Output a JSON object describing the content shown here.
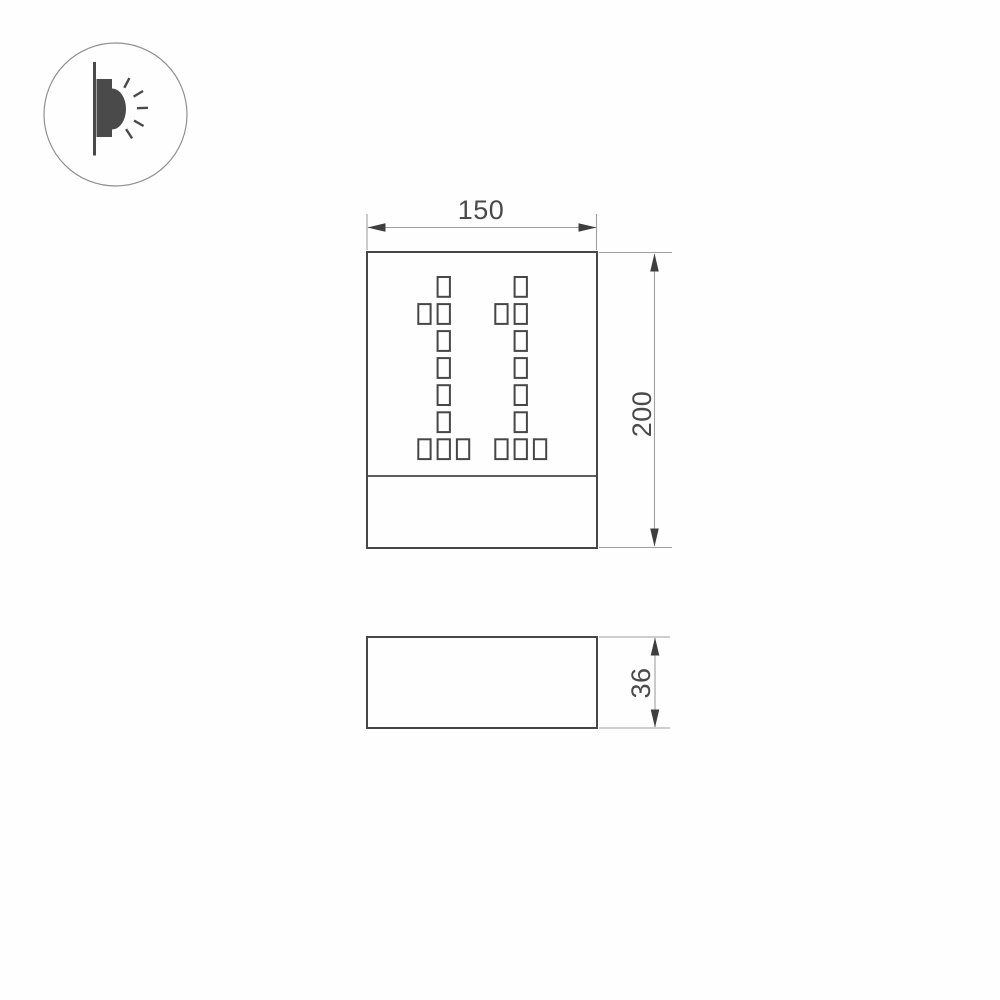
{
  "icon": {
    "name": "wall-light-icon"
  },
  "front_view": {
    "width_label": "150",
    "height_label": "200",
    "display_number": "11",
    "perforation_pattern": {
      "rows": 7,
      "cols": 3,
      "cells_per_row": [
        [
          1
        ],
        [
          0,
          1
        ],
        [
          1
        ],
        [
          1
        ],
        [
          1
        ],
        [
          1
        ],
        [
          0,
          1,
          2
        ]
      ]
    }
  },
  "side_view": {
    "depth_label": "36"
  },
  "colors": {
    "background": "#fefefe",
    "outline": "#474747",
    "dimension_line": "#9f9f9f",
    "arrow": "#3e3e3e",
    "text": "#4a4a4a",
    "icon_fill": "#4a4a4a",
    "icon_circle": "#8f8f8f"
  }
}
